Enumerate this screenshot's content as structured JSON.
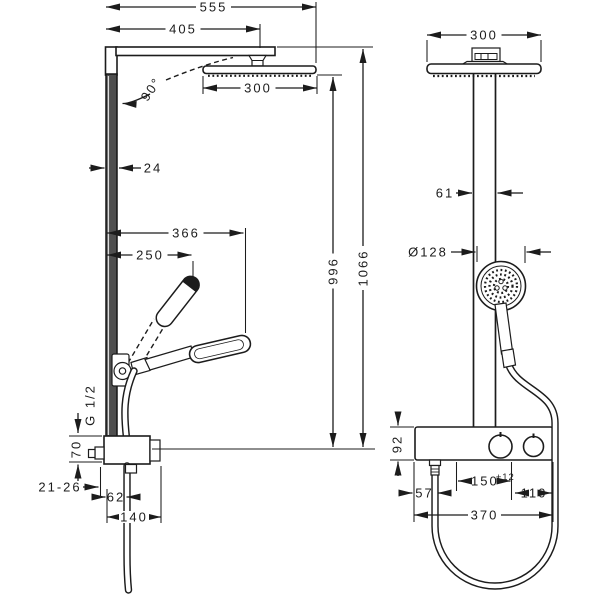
{
  "title": "shower-system-technical-drawing",
  "colors": {
    "background": "#ffffff",
    "line": "#1c1c1c"
  },
  "left_view": {
    "dims": {
      "overall_width": "555",
      "arm_length": "405",
      "head_width": "300",
      "bar_depth": "24",
      "handshower_reach": "366",
      "handshower_length": "250",
      "angle": "90°",
      "height_to_head": "996",
      "overall_height": "1066",
      "thread": "G 1/2",
      "valve_height": "70",
      "wall_range": "21-26",
      "hose_offset": "62",
      "valve_depth": "140"
    }
  },
  "right_view": {
    "dims": {
      "head_width": "300",
      "pipe_width": "61",
      "handshower_diameter": "Ø128",
      "body_height": "92",
      "supply_spacing": "150",
      "supply_tolerance": "±12",
      "outlet_offset": "57",
      "edge_offset": "110",
      "body_width": "370"
    }
  }
}
